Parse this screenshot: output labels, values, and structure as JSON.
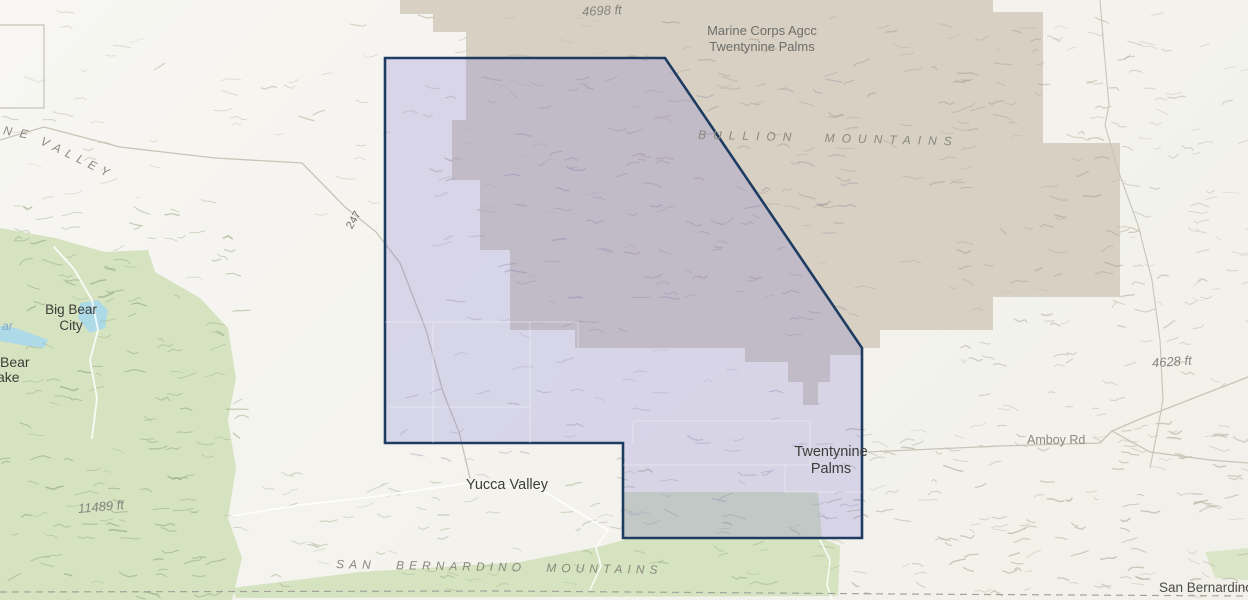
{
  "map": {
    "labels": {
      "elevation_4698": "4698 ft",
      "marine_base_line1": "Marine Corps Agcc",
      "marine_base_line2": "Twentynine Palms",
      "bullion_mountains": "BULLION MOUNTAINS",
      "valley_fragment_ne": "NE",
      "valley_fragment_valley": "VALLEY",
      "big_bear_city_line1": "Big Bear",
      "big_bear_city_line2": "City",
      "water_label_fragment": "ar",
      "lake_fragment_line1": "Bear",
      "lake_fragment_line2": "ake",
      "route_247": "247",
      "elevation_4628": "4628 ft",
      "amboy_rd": "Amboy Rd",
      "yucca_valley": "Yucca Valley",
      "twentynine_palms_line1": "Twentynine",
      "twentynine_palms_line2": "Palms",
      "elevation_11489": "11489 ft",
      "san_bernardino_mountains": "SAN BERNARDINO MOUNTAINS",
      "san_bernardino_county": "San Bernardino"
    },
    "colors": {
      "background": "#f4f3ee",
      "boundary_stroke": "#1e3c62",
      "boundary_fill": "rgba(126,118,212,0.24)",
      "military_base_fill": "#d7d0c3",
      "forest_fill": "#d6e3c1",
      "water_fill": "#aed9e6",
      "road_stroke": "#c8c4b7",
      "minor_road_stroke": "#ffffff",
      "county_dash_stroke": "#a3a39b",
      "parcel_line_stroke": "#ffffff"
    }
  }
}
